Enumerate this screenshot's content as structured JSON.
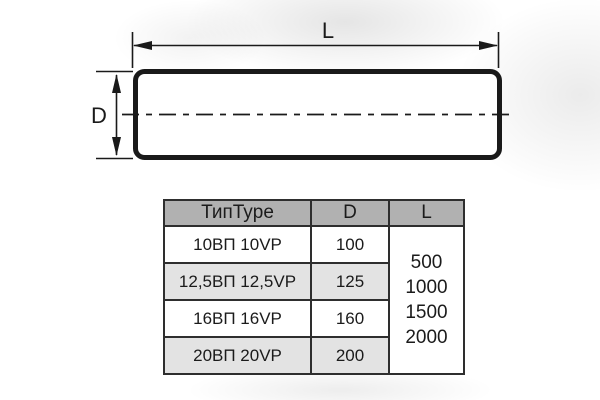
{
  "diagram": {
    "length_label": "L",
    "diameter_label": "D"
  },
  "table": {
    "headers": {
      "type": "ТипType",
      "d": "D",
      "l": "L"
    },
    "rows": [
      {
        "type": "10ВП 10VP",
        "d": "100"
      },
      {
        "type": "12,5ВП 12,5VP",
        "d": "125"
      },
      {
        "type": "16ВП 16VP",
        "d": "160"
      },
      {
        "type": "20ВП 20VP",
        "d": "200"
      }
    ],
    "l_values": [
      "500",
      "1000",
      "1500",
      "2000"
    ]
  },
  "colors": {
    "line": "#1a1a1a",
    "table_border": "#2e2e2e",
    "header_bg": "#b1b1b1",
    "row_alt_bg": "#e3e3e3",
    "background": "#ffffff"
  }
}
